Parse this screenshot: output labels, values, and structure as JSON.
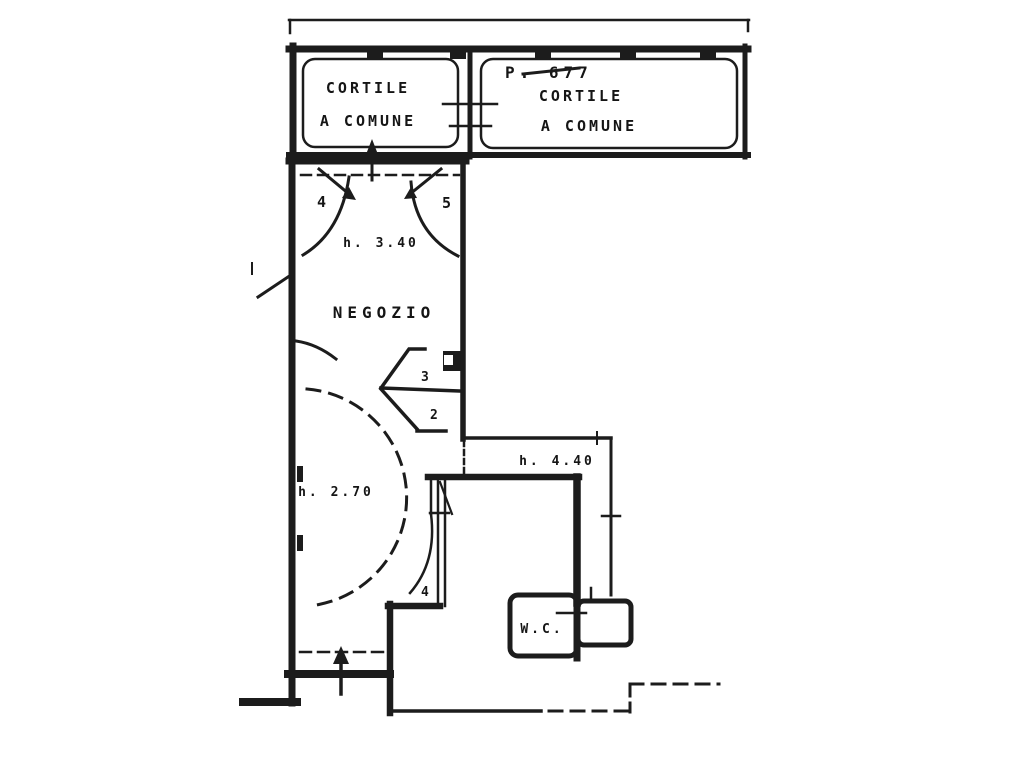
{
  "plan": {
    "title_note": "",
    "ink_color": "#1c1c1c",
    "paper_color": "#ffffff",
    "courtyard_left": {
      "line1": "CORTILE",
      "line2": "A COMUNE"
    },
    "courtyard_right": {
      "parcel": "P. 677",
      "line1": "CORTILE",
      "line2": "A COMUNE"
    },
    "shop": {
      "name": "NEGOZIO",
      "height_front": "h. 3.40",
      "height_back": "h. 2.70"
    },
    "corridor": {
      "height": "h. 4.40"
    },
    "wc": {
      "label": "W.C."
    },
    "door_numbers": {
      "front_left": "4",
      "front_right": "5",
      "mid_upper": "3",
      "mid_lower": "2",
      "rear": "4"
    }
  }
}
